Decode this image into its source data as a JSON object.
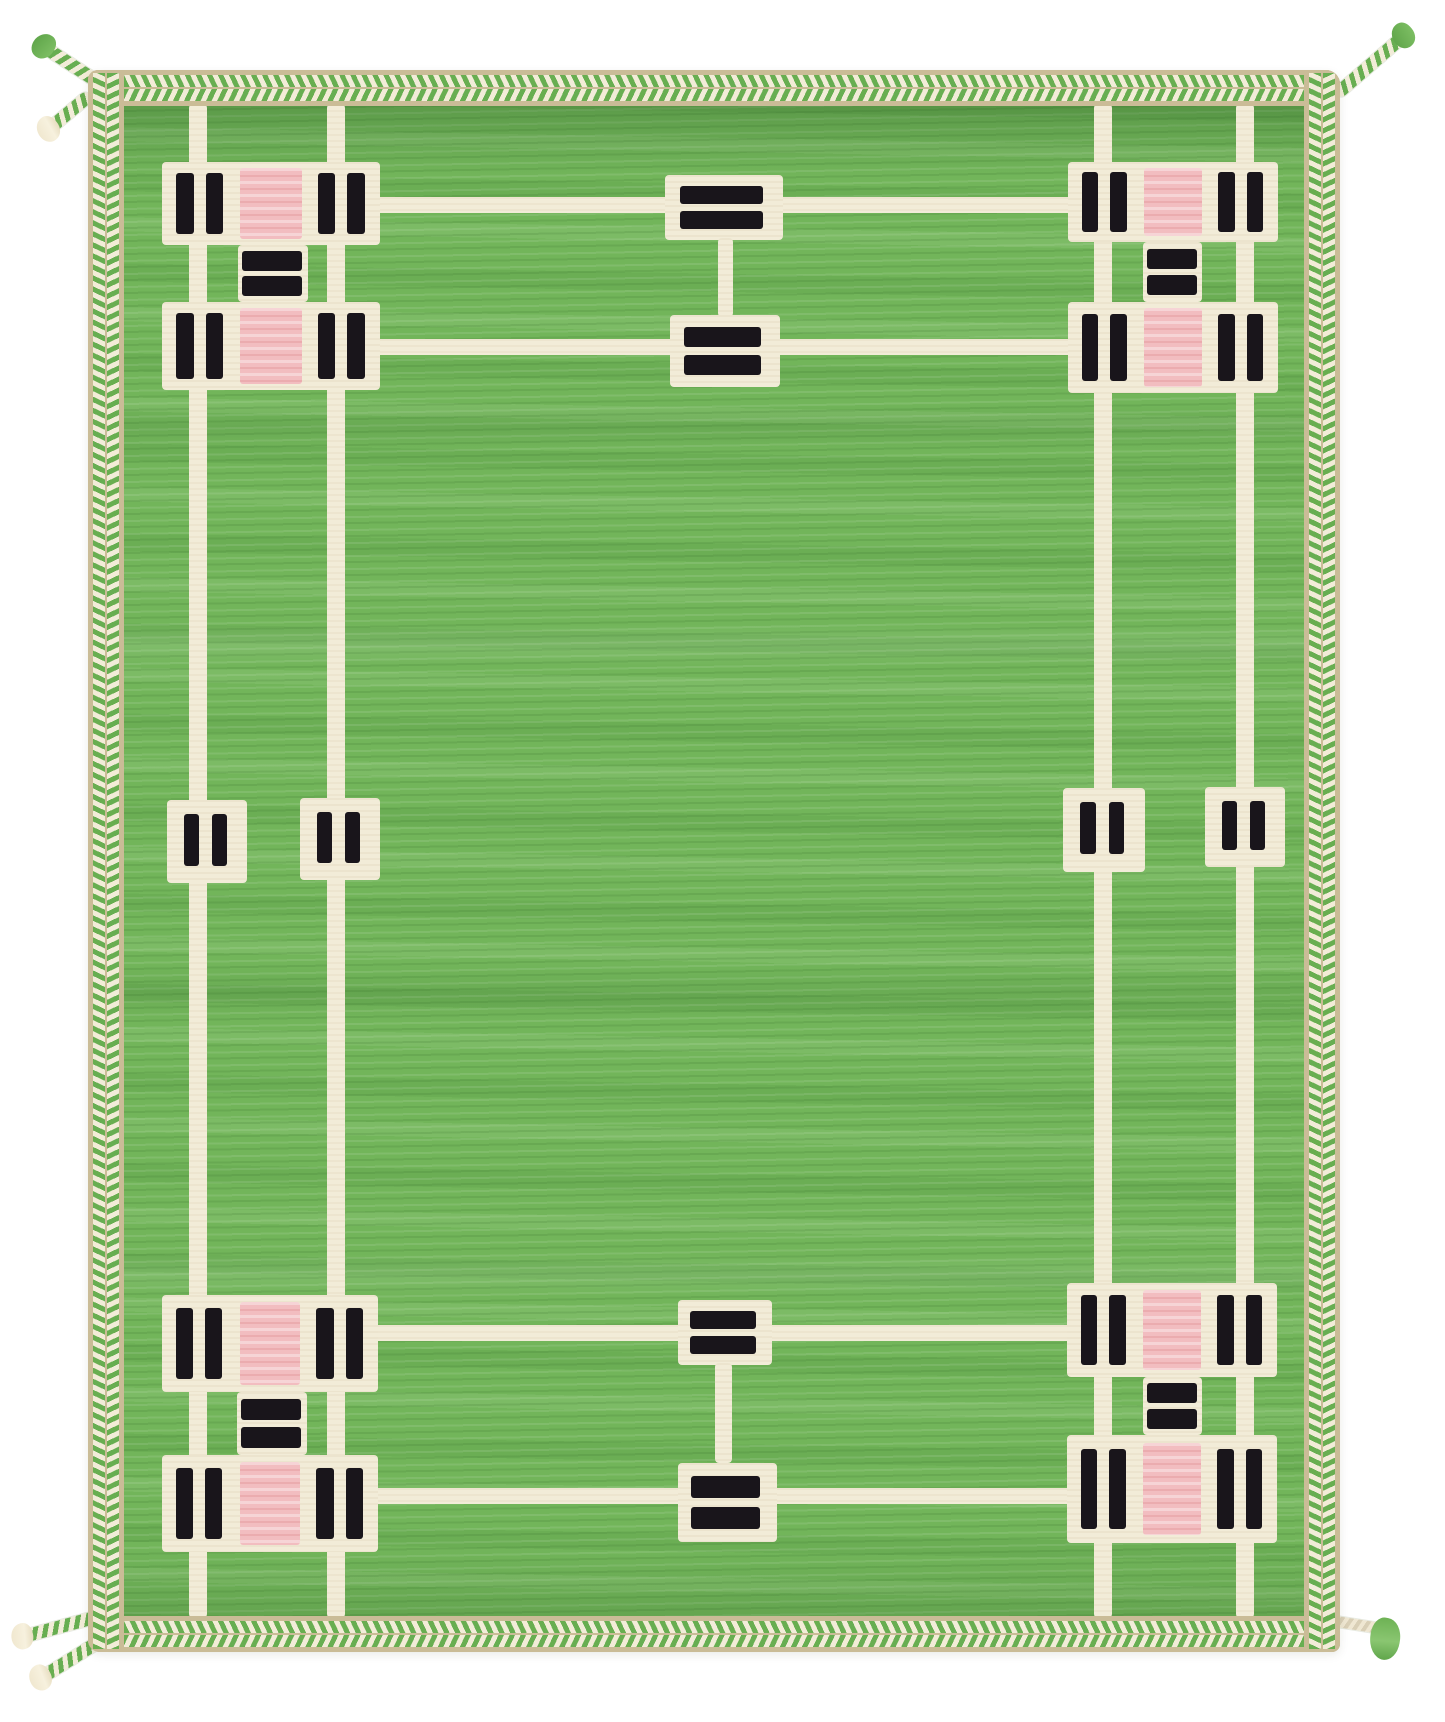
{
  "meta": {
    "description": "Photograph of a hand-knotted green wool pile rug with an ivory Arts-and-Crafts style geometric lattice: four corner motifs of striped black bars with pink center squares, dumbbell-shaped center motifs at top and bottom, small striped squares at mid-sides, a tan border with a two-row green and ivory chevron braid, and braided corner tassels, shown on a white background.",
    "aria_label": "Green pile rug with ivory geometric grid pattern, black bar groups, pink squares, chevron braid border and corner tassels"
  },
  "palette": {
    "page_background": "#ffffff",
    "field_green": "#72b55a",
    "field_green_dark": "#4f8f3f",
    "field_green_light": "#93cb7a",
    "ivory": "#f2ecd8",
    "border_tan": "#cabc97",
    "motif_black": "#19151b",
    "motif_pink": "#f2bdc0",
    "braid_green": "#68ae51"
  },
  "structure": {
    "corner_motifs": 4,
    "center_dumbbell_motifs": 2,
    "mid_side_squares": 4,
    "vertical_grid_lines": 4,
    "horizontal_grid_lines": 4,
    "tassels": 6,
    "border_style": "two-row chevron braid on tan ground"
  }
}
